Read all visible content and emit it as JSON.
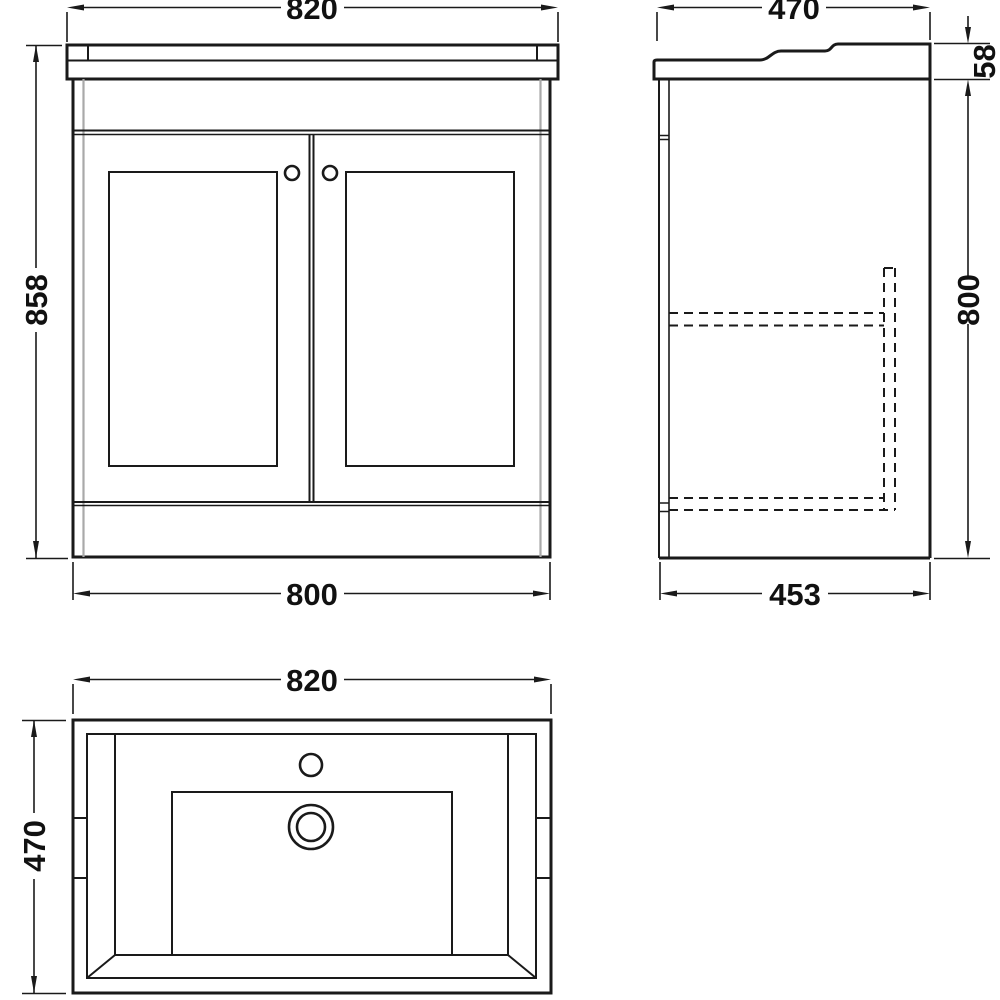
{
  "colors": {
    "line": "#1a1a1a",
    "side_panel_gray": "#a9a9a9",
    "background": "#ffffff"
  },
  "dimensions": {
    "front": {
      "top_width": "820",
      "height": "858",
      "bottom_width": "800"
    },
    "side": {
      "top_depth": "470",
      "worktop_thickness": "58",
      "body_height": "800",
      "bottom_depth": "453"
    },
    "plan": {
      "width": "820",
      "depth": "470"
    }
  }
}
